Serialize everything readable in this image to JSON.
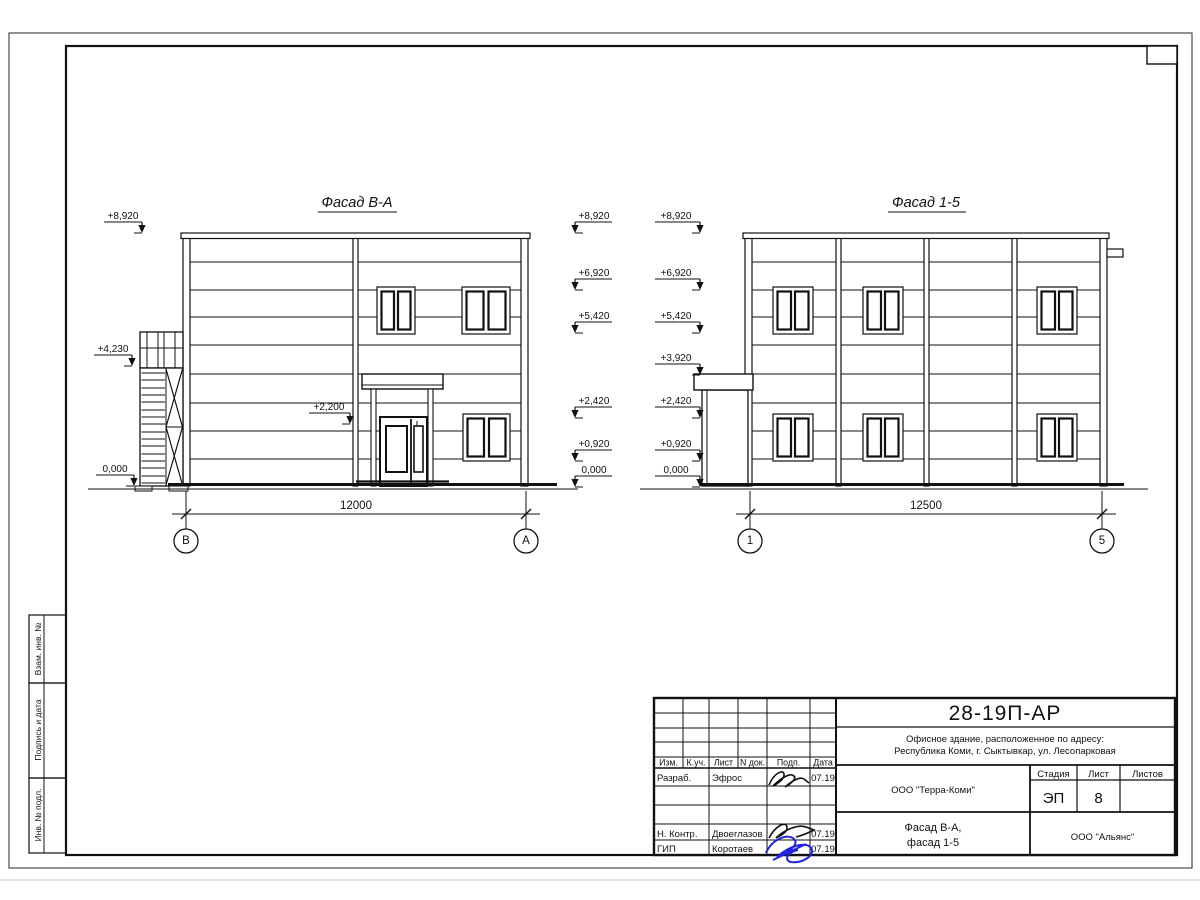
{
  "titleblock": {
    "doc_number": "28-19П-АР",
    "project_line1": "Офисное здание, расположенное по адресу:",
    "project_line2": "Республика Коми, г. Сыктывкар, ул. Лесопарковая",
    "design_org": "ООО \"Терра-Коми\"",
    "drawing_title_line1": "Фасад В-А,",
    "drawing_title_line2": "фасад 1-5",
    "contractor_org": "ООО \"Альянс\"",
    "stage_label": "Стадия",
    "stage": "ЭП",
    "sheet_label": "Лист",
    "sheet": "8",
    "sheets_label": "Листов",
    "sheets": "",
    "columns": [
      "Изм.",
      "К.уч.",
      "Лист",
      "N док.",
      "Подп.",
      "Дата"
    ],
    "rows": [
      {
        "role": "Разраб.",
        "name": "Эфрос",
        "date": "07.19"
      },
      {
        "role": "Н. Контр.",
        "name": "Двоеглазов",
        "date": "07.19"
      },
      {
        "role": "ГИП",
        "name": "Коротаев",
        "date": "07.19"
      }
    ]
  },
  "side_column_labels": [
    "Взам. инв. №",
    "Подпись и дата",
    "Инв. № подл."
  ],
  "facade_ba": {
    "title": "Фасад В-А",
    "dimension": "12000",
    "axis_start": "В",
    "axis_end": "А",
    "left_marks": [
      "+8,920",
      "+4,230",
      "0,000"
    ],
    "door_mark": "+2,200",
    "right_marks": [
      "+8,920",
      "+6,920",
      "+5,420",
      "+2,420",
      "+0,920",
      "0,000"
    ]
  },
  "facade_15": {
    "title": "Фасад 1-5",
    "dimension": "12500",
    "axis_start": "1",
    "axis_end": "5",
    "left_marks": [
      "+8,920",
      "+6,920",
      "+5,420",
      "+3,920",
      "+2,420",
      "+0,920",
      "0,000"
    ]
  }
}
